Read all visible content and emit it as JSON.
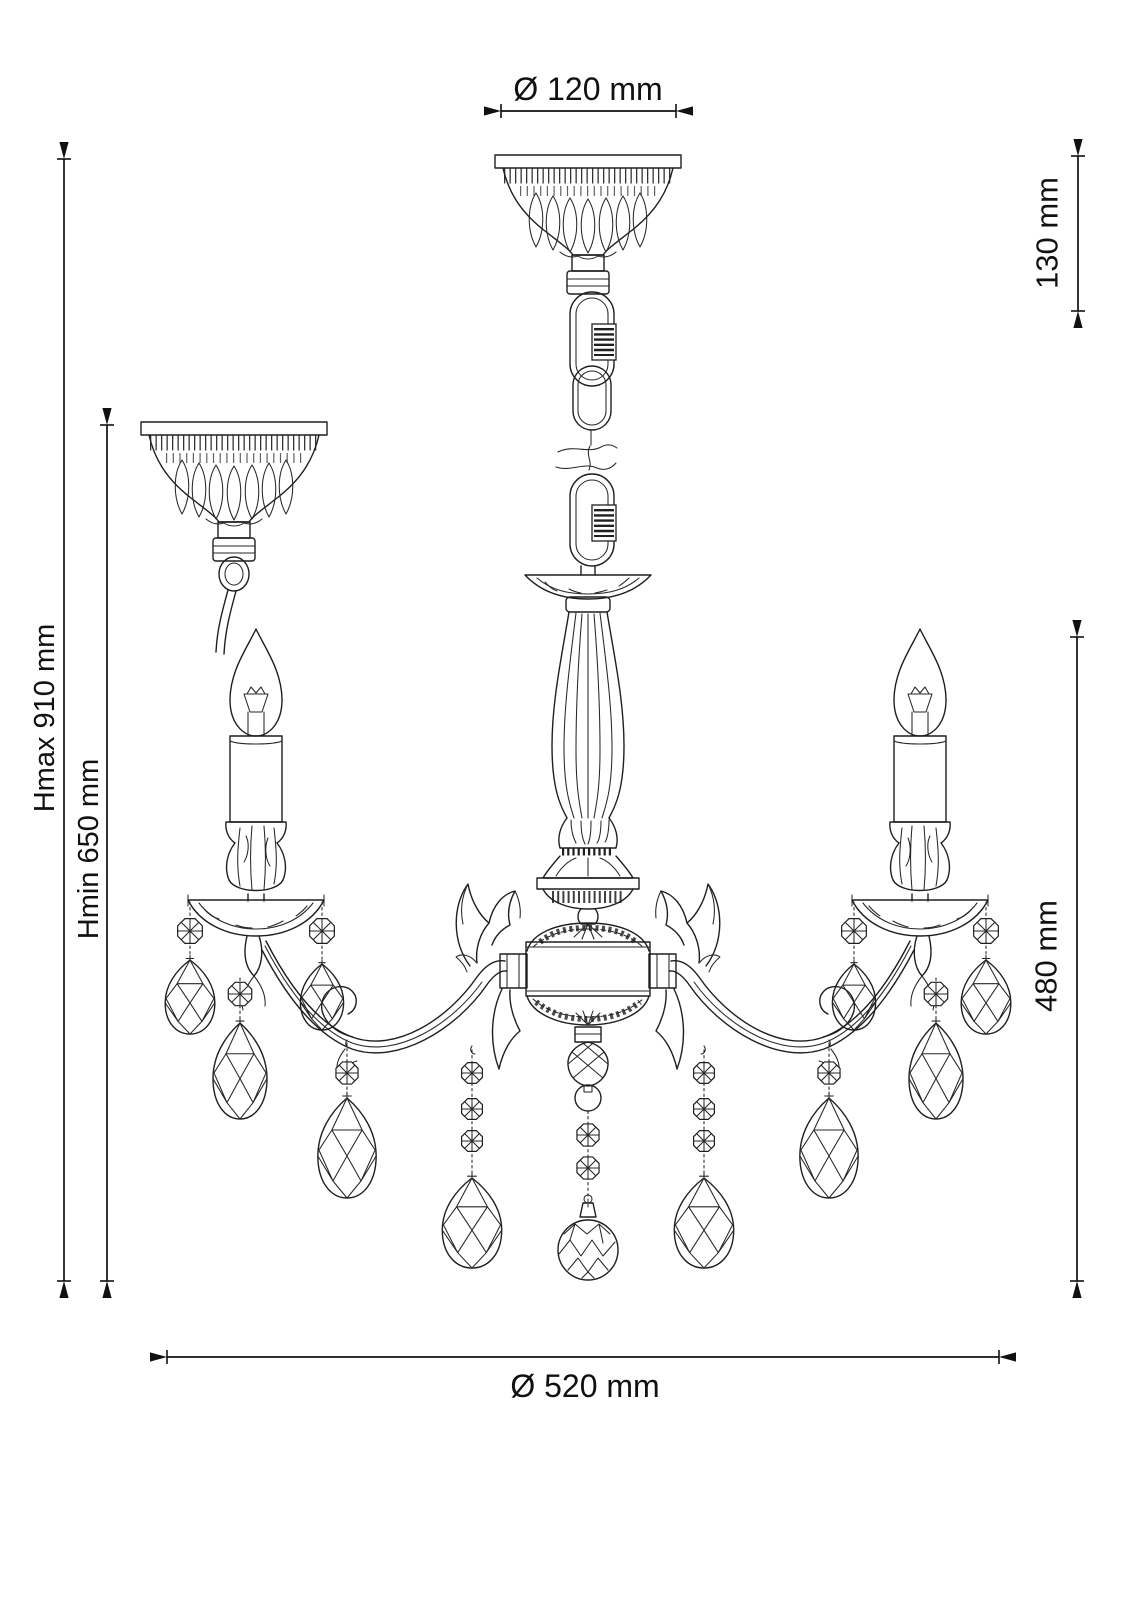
{
  "page": {
    "background": "#ffffff",
    "ink": "#1f1f1f",
    "subject": "Technical dimension drawing of a 3-arm crystal chandelier"
  },
  "dimensions": {
    "canopy_diameter": "Ø 120 mm",
    "canopy_height": "130 mm",
    "height_max": "Hmax 910 mm",
    "height_min": "Hmin 650 mm",
    "fixture_height": "480 mm",
    "fixture_diameter": "Ø 520 mm"
  }
}
